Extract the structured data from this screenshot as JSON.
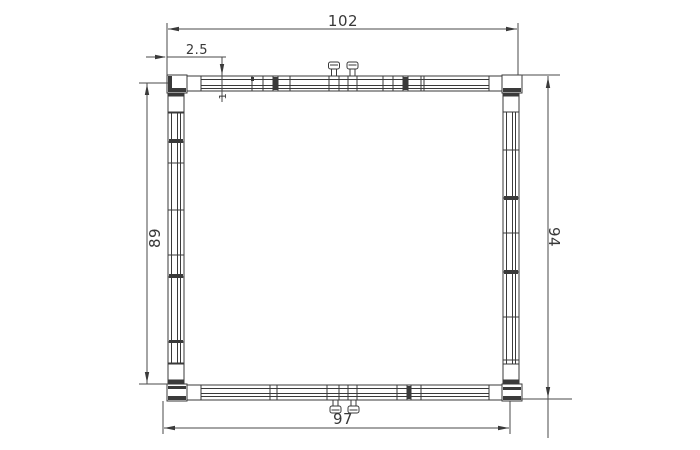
{
  "drawing": {
    "type": "technical-plan-drawing",
    "subject": "rectangular frame profile section with corner connectors and clamp screws",
    "colors": {
      "background": "#ffffff",
      "line": "#3a3a3a",
      "dimension_text": "#383838"
    },
    "dimensions": {
      "overall_width_top": "102",
      "corner_offset": "2.5",
      "profile_wall_thickness": "1",
      "inner_height_left": "89",
      "overall_height_right": "94",
      "inner_width_bottom": "97"
    }
  }
}
